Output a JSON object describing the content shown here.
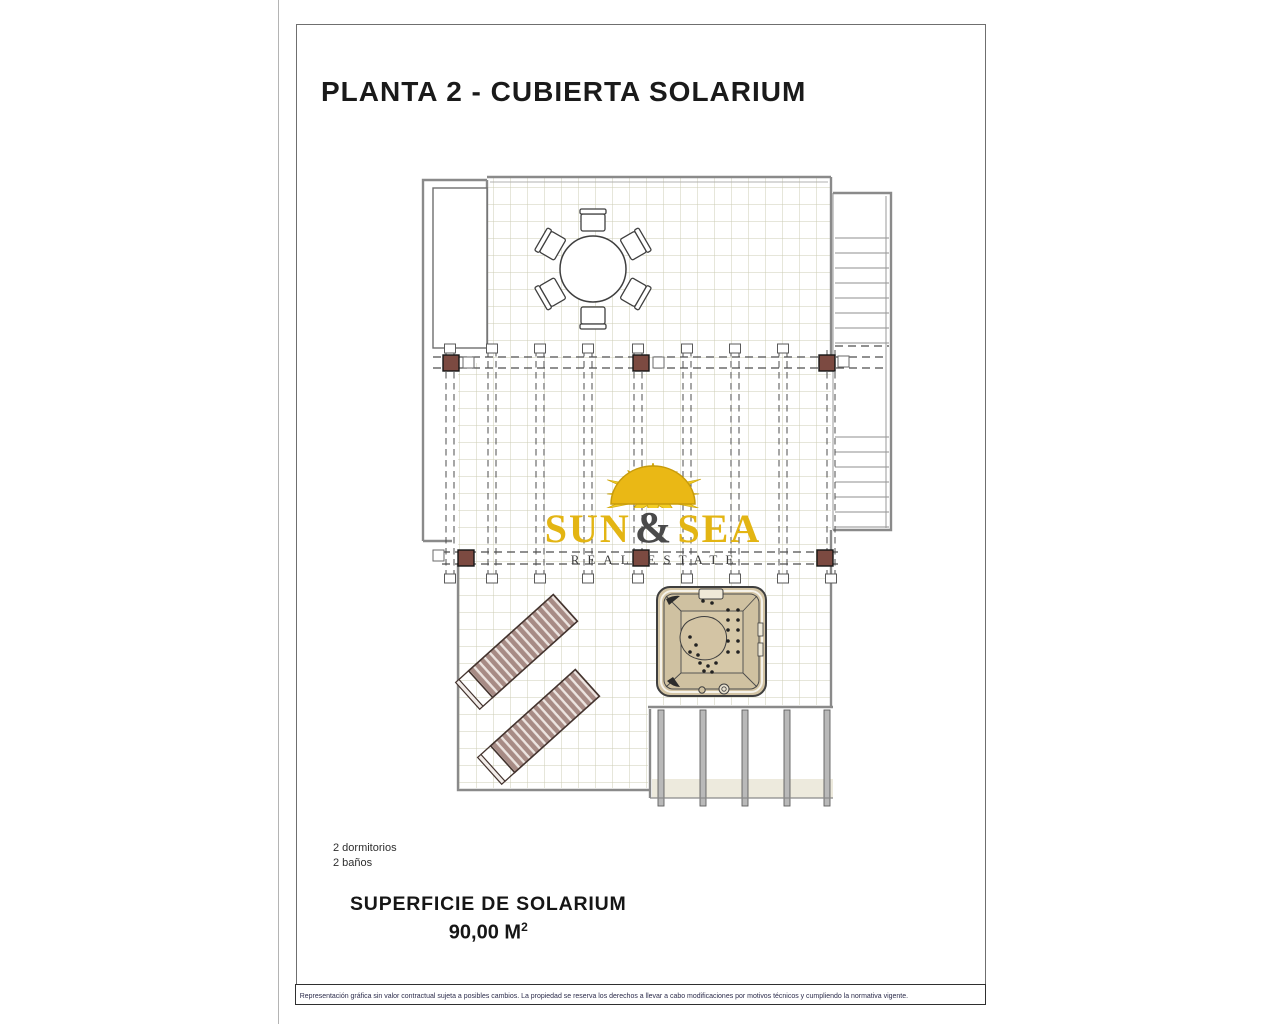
{
  "sheet": {
    "title": "PLANTA 2 - CUBIERTA SOLARIUM",
    "features": [
      "2 dormitorios",
      "2 baños"
    ],
    "area": {
      "label": "SUPERFICIE DE SOLARIUM",
      "value": "90,00 M",
      "sup": "2"
    },
    "disclaimer": "Representación gráfica sin valor contractual sujeta a posibles cambios. La propiedad se reserva los derechos a llevar a cabo modificaciones por motivos técnicos y cumpliendo la normativa vigente."
  },
  "watermark": {
    "brand_word1": "SUN",
    "brand_amp": "&",
    "brand_word2": "SEA",
    "subtitle": "REAL ESTATE"
  },
  "colors": {
    "brand_yellow": "#e3b513",
    "sun_yellow": "#f2cd25",
    "pergola_post_brown": "#7c4a41",
    "lounger_mauve": "#a78b85",
    "jacuzzi_tan": "#d3c4a4",
    "tile_grid": "#ccccb5",
    "wall_gray": "#8a8a8a"
  }
}
